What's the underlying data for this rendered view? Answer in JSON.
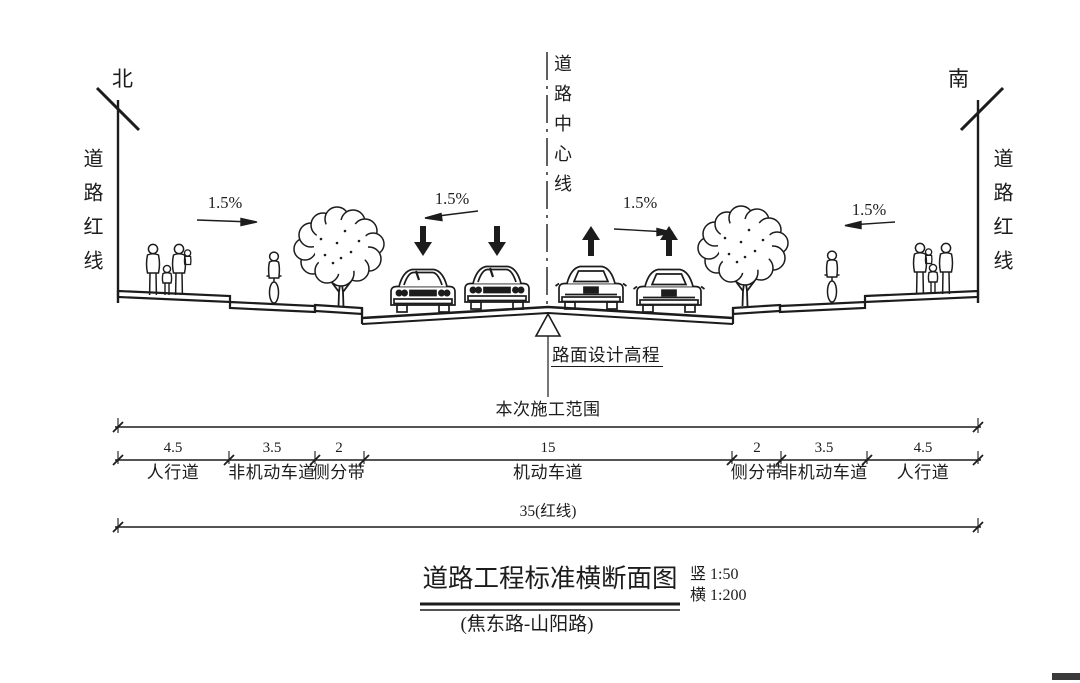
{
  "drawing": {
    "orientation_north": "北",
    "orientation_south": "南",
    "redline_left": "道路红线",
    "redline_right": "道路红线",
    "centerline": "道路中心线",
    "elevation_marker": "路面设计高程",
    "slope_sidewalk_left": "1.5%",
    "slope_carriageway_left": "1.5%",
    "slope_carriageway_right": "1.5%",
    "slope_sidewalk_right": "1.5%"
  },
  "dimensions": {
    "construction_scope": "本次施工范围",
    "total_redline": "35(红线)",
    "segments": [
      {
        "width": "4.5",
        "name": "人行道"
      },
      {
        "width": "3.5",
        "name": "非机动车道"
      },
      {
        "width": "2",
        "name": "侧分带"
      },
      {
        "width": "15",
        "name": "机动车道"
      },
      {
        "width": "2",
        "name": "侧分带"
      },
      {
        "width": "3.5",
        "name": "非机动车道"
      },
      {
        "width": "4.5",
        "name": "人行道"
      }
    ]
  },
  "title_block": {
    "title": "道路工程标准横断面图",
    "subtitle": "(焦东路-山阳路)",
    "scale_vertical": "竖 1:50",
    "scale_horizontal": "横 1:200"
  },
  "colors": {
    "ink": "#1c1c1c",
    "background": "#ffffff"
  }
}
